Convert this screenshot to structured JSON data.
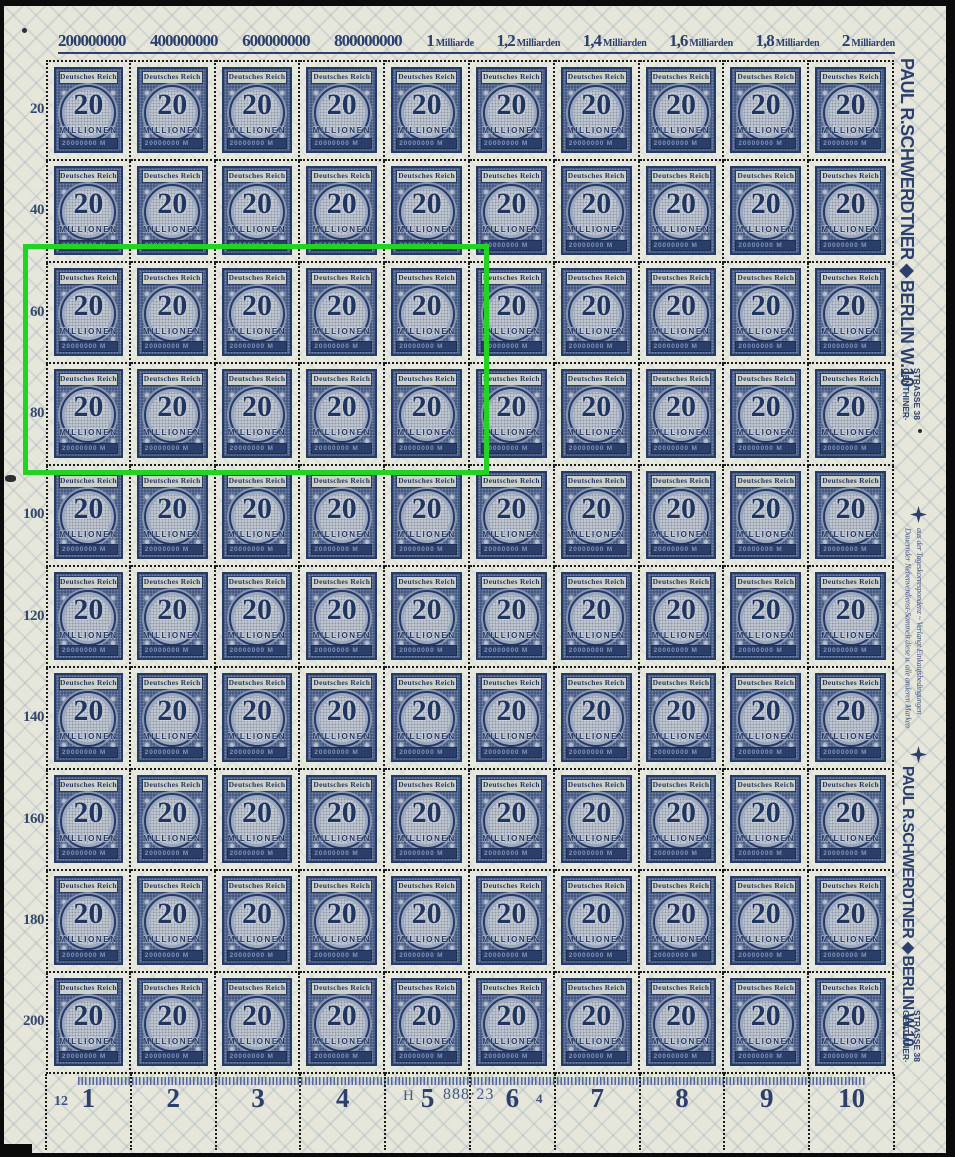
{
  "top_scale": {
    "labels": [
      {
        "num": "200000000",
        "word": ""
      },
      {
        "num": "400000000",
        "word": ""
      },
      {
        "num": "600000000",
        "word": ""
      },
      {
        "num": "800000000",
        "word": ""
      },
      {
        "num": "1",
        "word": "Milliarde"
      },
      {
        "num": "1,2",
        "word": "Milliarden"
      },
      {
        "num": "1,4",
        "word": "Milliarden"
      },
      {
        "num": "1,6",
        "word": "Milliarden"
      },
      {
        "num": "1,8",
        "word": "Milliarden"
      },
      {
        "num": "2",
        "word": "Milliarden"
      }
    ]
  },
  "left_scale": {
    "values": [
      "20",
      "40",
      "60",
      "80",
      "100",
      "120",
      "140",
      "160",
      "180",
      "200"
    ]
  },
  "grid": {
    "rows": 10,
    "cols": 10
  },
  "stamp": {
    "country": "Deutsches Reich",
    "value": "20",
    "denomination": "MILLIONEN",
    "face_value": "20000000 M"
  },
  "right_margin": {
    "dealer_line": "PAUL R.SCHWERDTNER◆BERLIN W.10",
    "address": "GENTHINER·\nSTRASSE 38",
    "ad": "Dauernder Nebenverdienst-Sammelt diese u. alle anderen Marken\naus der Tageskorrespondenz ~ Verlangt Einkaufsbedingungen"
  },
  "bottom_margin": {
    "left_number": "12",
    "column_numbers": [
      "1",
      "2",
      "3",
      "4",
      "5",
      "6",
      "7",
      "8",
      "9",
      "10"
    ],
    "han_prefix": "H",
    "han_suffix": "888·23",
    "plate_number": "4"
  },
  "annotation": {
    "x": 23,
    "y": 244,
    "width": 466,
    "height": 231,
    "color": "#21d421"
  },
  "colors": {
    "ink": "#2b3e6b",
    "paper": "#e6e7da",
    "perforation": "#1b1b1b"
  }
}
